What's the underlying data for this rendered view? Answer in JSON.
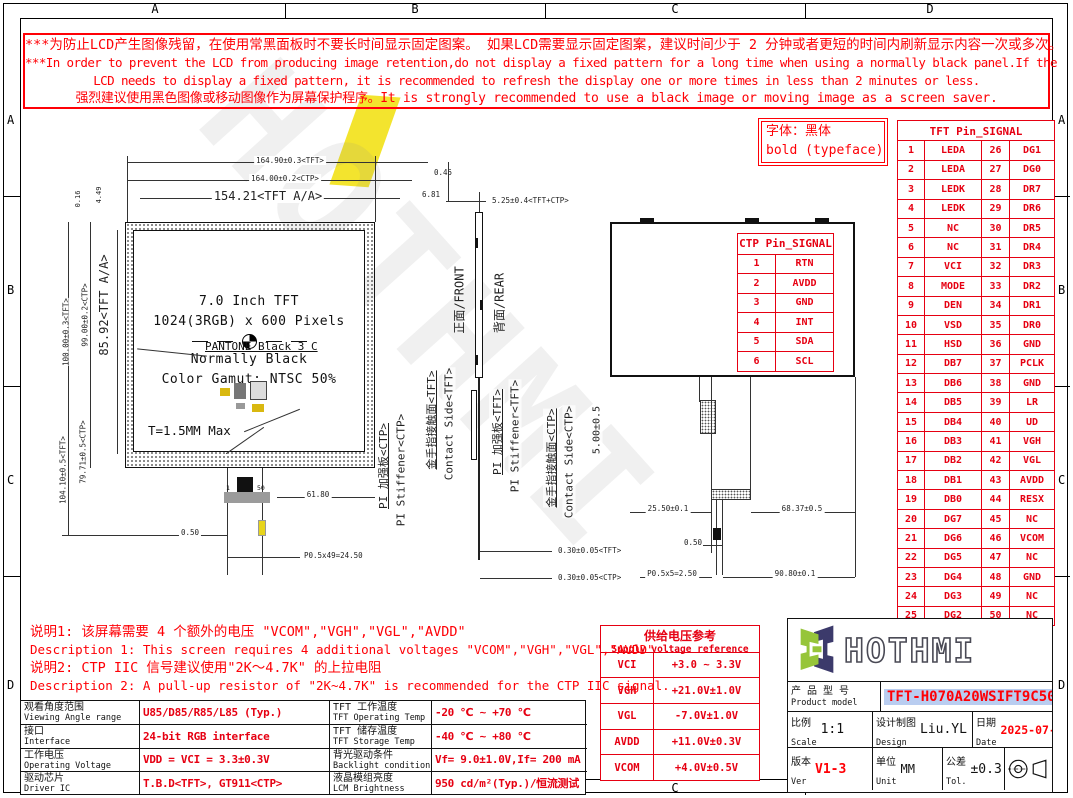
{
  "colors": {
    "red": "#ff0006",
    "table_red": "#e60012",
    "logo_green": "#96c53a",
    "logo_navy": "#3c3a6b",
    "highlight_blue": "#b9cdf0",
    "watermark_yellow": "#f2e21c"
  },
  "zones": [
    "A",
    "B",
    "C",
    "D"
  ],
  "warning": {
    "lines": [
      "***为防止LCD产生图像残留，在使用常黑面板时不要长时间显示固定图案。 如果LCD需要显示固定图案，建议时间少于 2 分钟或者更短的时间内刷新显示内容一次或多次。",
      "***In order to prevent the LCD from producing image retention,do not display a fixed pattern for a long time when using a normally black panel.If the",
      "LCD needs to display a fixed pattern, it is recommended to refresh the display one or more times in less than 2 minutes or less.",
      "强烈建议使用黑色图像或移动图像作为屏幕保护程序。It is strongly recommended to use a black image or moving image as a screen saver."
    ]
  },
  "typeface_note": {
    "line1": "字体：黑体",
    "line2": "bold (typeface)"
  },
  "watermark": {
    "text": "HOTHMI"
  },
  "front_view": {
    "title_lines": [
      "7.0 Inch TFT",
      "1024(3RGB) x 600 Pixels",
      "Normally Black",
      "Color Gamut: NTSC 50%"
    ],
    "pantone": "PANTONE Black 3 C",
    "thickness": "T=1.5MM Max",
    "pin_first": "1",
    "pin_last": "50",
    "dims": {
      "width_tft": "164.90±0.3<TFT>",
      "width_ctp": "164.00±0.2<CTP>",
      "width_aa": "154.21<TFT A/A>",
      "edge_top": "0.45",
      "edge_side": "6.81",
      "height_aa": "85.92<TFT A/A>",
      "height_ctp": "99.00±0.2<CTP>",
      "height_tft": "100.00±0.3<TFT>",
      "edge_small1": "0.16",
      "edge_small2": "4.49",
      "fpc_ctp": "79.71±0.5<CTP>",
      "fpc_tft": "104.10±0.5<TFT>",
      "fpc_width": "61.80",
      "pin_width": "0.50",
      "pin_pitch": "P0.5x49=24.50"
    }
  },
  "side_view": {
    "front_label": "正面/FRONT",
    "rear_label": "背面/REAR",
    "labels": [
      {
        "cn": "PI 加强板<CTP>",
        "en": "PI Stiffener<CTP>"
      },
      {
        "cn": "金手指接触面<TFT>",
        "en": "Contact Side<TFT>"
      },
      {
        "cn": "PI 加强板<TFT>",
        "en": "PI Stiffener<TFT>"
      },
      {
        "cn": "金手指接触面<CTP>",
        "en": "Contact Side<CTP>"
      }
    ],
    "dims": {
      "total_thickness": "5.25±0.4<TFT+CTP>",
      "fpc_tft": "0.30±0.05<TFT>",
      "fpc_ctp": "0.30±0.05<CTP>"
    }
  },
  "rear_view": {
    "dims": {
      "fpc_height": "5.00±0.5",
      "offset_left": "25.50±0.1",
      "offset_right": "68.37±0.5",
      "pin_width": "0.50",
      "pin_pitch": "P0.5x5=2.50",
      "fpc_pos": "90.80±0.1"
    }
  },
  "tft_pin_table": {
    "title": "TFT Pin_SIGNAL",
    "rows": [
      {
        "p1": "1",
        "s1": "LEDA",
        "p2": "26",
        "s2": "DG1"
      },
      {
        "p1": "2",
        "s1": "LEDA",
        "p2": "27",
        "s2": "DG0"
      },
      {
        "p1": "3",
        "s1": "LEDK",
        "p2": "28",
        "s2": "DR7"
      },
      {
        "p1": "4",
        "s1": "LEDK",
        "p2": "29",
        "s2": "DR6"
      },
      {
        "p1": "5",
        "s1": "NC",
        "p2": "30",
        "s2": "DR5"
      },
      {
        "p1": "6",
        "s1": "NC",
        "p2": "31",
        "s2": "DR4"
      },
      {
        "p1": "7",
        "s1": "VCI",
        "p2": "32",
        "s2": "DR3"
      },
      {
        "p1": "8",
        "s1": "MODE",
        "p2": "33",
        "s2": "DR2"
      },
      {
        "p1": "9",
        "s1": "DEN",
        "p2": "34",
        "s2": "DR1"
      },
      {
        "p1": "10",
        "s1": "VSD",
        "p2": "35",
        "s2": "DR0"
      },
      {
        "p1": "11",
        "s1": "HSD",
        "p2": "36",
        "s2": "GND"
      },
      {
        "p1": "12",
        "s1": "DB7",
        "p2": "37",
        "s2": "PCLK"
      },
      {
        "p1": "13",
        "s1": "DB6",
        "p2": "38",
        "s2": "GND"
      },
      {
        "p1": "14",
        "s1": "DB5",
        "p2": "39",
        "s2": "LR"
      },
      {
        "p1": "15",
        "s1": "DB4",
        "p2": "40",
        "s2": "UD"
      },
      {
        "p1": "16",
        "s1": "DB3",
        "p2": "41",
        "s2": "VGH"
      },
      {
        "p1": "17",
        "s1": "DB2",
        "p2": "42",
        "s2": "VGL"
      },
      {
        "p1": "18",
        "s1": "DB1",
        "p2": "43",
        "s2": "AVDD"
      },
      {
        "p1": "19",
        "s1": "DB0",
        "p2": "44",
        "s2": "RESX"
      },
      {
        "p1": "20",
        "s1": "DG7",
        "p2": "45",
        "s2": "NC"
      },
      {
        "p1": "21",
        "s1": "DG6",
        "p2": "46",
        "s2": "VCOM"
      },
      {
        "p1": "22",
        "s1": "DG5",
        "p2": "47",
        "s2": "NC"
      },
      {
        "p1": "23",
        "s1": "DG4",
        "p2": "48",
        "s2": "GND"
      },
      {
        "p1": "24",
        "s1": "DG3",
        "p2": "49",
        "s2": "NC"
      },
      {
        "p1": "25",
        "s1": "DG2",
        "p2": "50",
        "s2": "NC"
      }
    ]
  },
  "ctp_pin_table": {
    "title": "CTP Pin_SIGNAL",
    "rows": [
      {
        "p": "1",
        "s": "RTN"
      },
      {
        "p": "2",
        "s": "AVDD"
      },
      {
        "p": "3",
        "s": "GND"
      },
      {
        "p": "4",
        "s": "INT"
      },
      {
        "p": "5",
        "s": "SDA"
      },
      {
        "p": "6",
        "s": "SCL"
      }
    ]
  },
  "supply_table": {
    "title_cn": "供给电压参考",
    "title_en": "Supply voltage reference",
    "rows": [
      {
        "name": "VCI",
        "value": "+3.0 ~ 3.3V"
      },
      {
        "name": "VGH",
        "value": "+21.0V±1.0V"
      },
      {
        "name": "VGL",
        "value": "-7.0V±1.0V"
      },
      {
        "name": "AVDD",
        "value": "+11.0V±0.3V"
      },
      {
        "name": "VCOM",
        "value": "+4.0V±0.5V"
      }
    ]
  },
  "notes": {
    "lines": [
      "说明1: 该屏幕需要 4 个额外的电压 \"VCOM\",\"VGH\",\"VGL\",\"AVDD\"",
      "Description 1: This screen requires 4 additional voltages \"VCOM\",\"VGH\",\"VGL\",\"AVDD\"",
      "说明2: CTP IIC 信号建议使用\"2K～4.7K\" 的上拉电阻",
      "Description 2: A pull-up resistor of \"2K~4.7K\" is recommended for the CTP IIC signal."
    ]
  },
  "spec_table": {
    "rows": [
      {
        "l1cn": "观看角度范围",
        "l1en": "Viewing Angle range",
        "v1": "U85/D85/R85/L85 (Typ.)",
        "l2cn": "TFT 工作温度",
        "l2en": "TFT Operating Temp",
        "v2": "-20 ℃ ~ +70 ℃"
      },
      {
        "l1cn": "接口",
        "l1en": "Interface",
        "v1": "24-bit RGB interface",
        "l2cn": "TFT 储存温度",
        "l2en": "TFT Storage Temp",
        "v2": "-40 ℃ ~ +80 ℃"
      },
      {
        "l1cn": "工作电压",
        "l1en": "Operating Voltage",
        "v1": "VDD = VCI = 3.3±0.3V",
        "l2cn": "背光驱动条件",
        "l2en": "Backlight conditions",
        "v2": "Vf= 9.0±1.0V,If= 200 mA"
      },
      {
        "l1cn": "驱动芯片",
        "l1en": "Driver IC",
        "v1": "T.B.D<TFT>, GT911<CTP>",
        "l2cn": "液晶模组亮度",
        "l2en": "LCM Brightness",
        "v2": "950 cd/m²(Typ.)/恒流测试"
      }
    ]
  },
  "title_block": {
    "logo": "HOTHMI",
    "product_label_cn": "产 品 型 号",
    "product_label_en": "Product model",
    "product_model": "TFT-H070A20WSIFT9C50",
    "scale_label_cn": "比例",
    "scale_label_en": "Scale",
    "scale": "1:1",
    "design_label_cn": "设计制图",
    "design_label_en": "Design",
    "designer": "Liu.YL",
    "date_label_cn": "日期",
    "date_label_en": "Date",
    "date": "2025-07-25",
    "ver_label_cn": "版本",
    "ver_label_en": "Ver",
    "version": "V1-3",
    "unit_label_cn": "单位",
    "unit_label_en": "Unit",
    "unit": "MM",
    "tol_label_cn": "公差",
    "tol_label_en": "Tol.",
    "tolerance": "±0.3"
  }
}
